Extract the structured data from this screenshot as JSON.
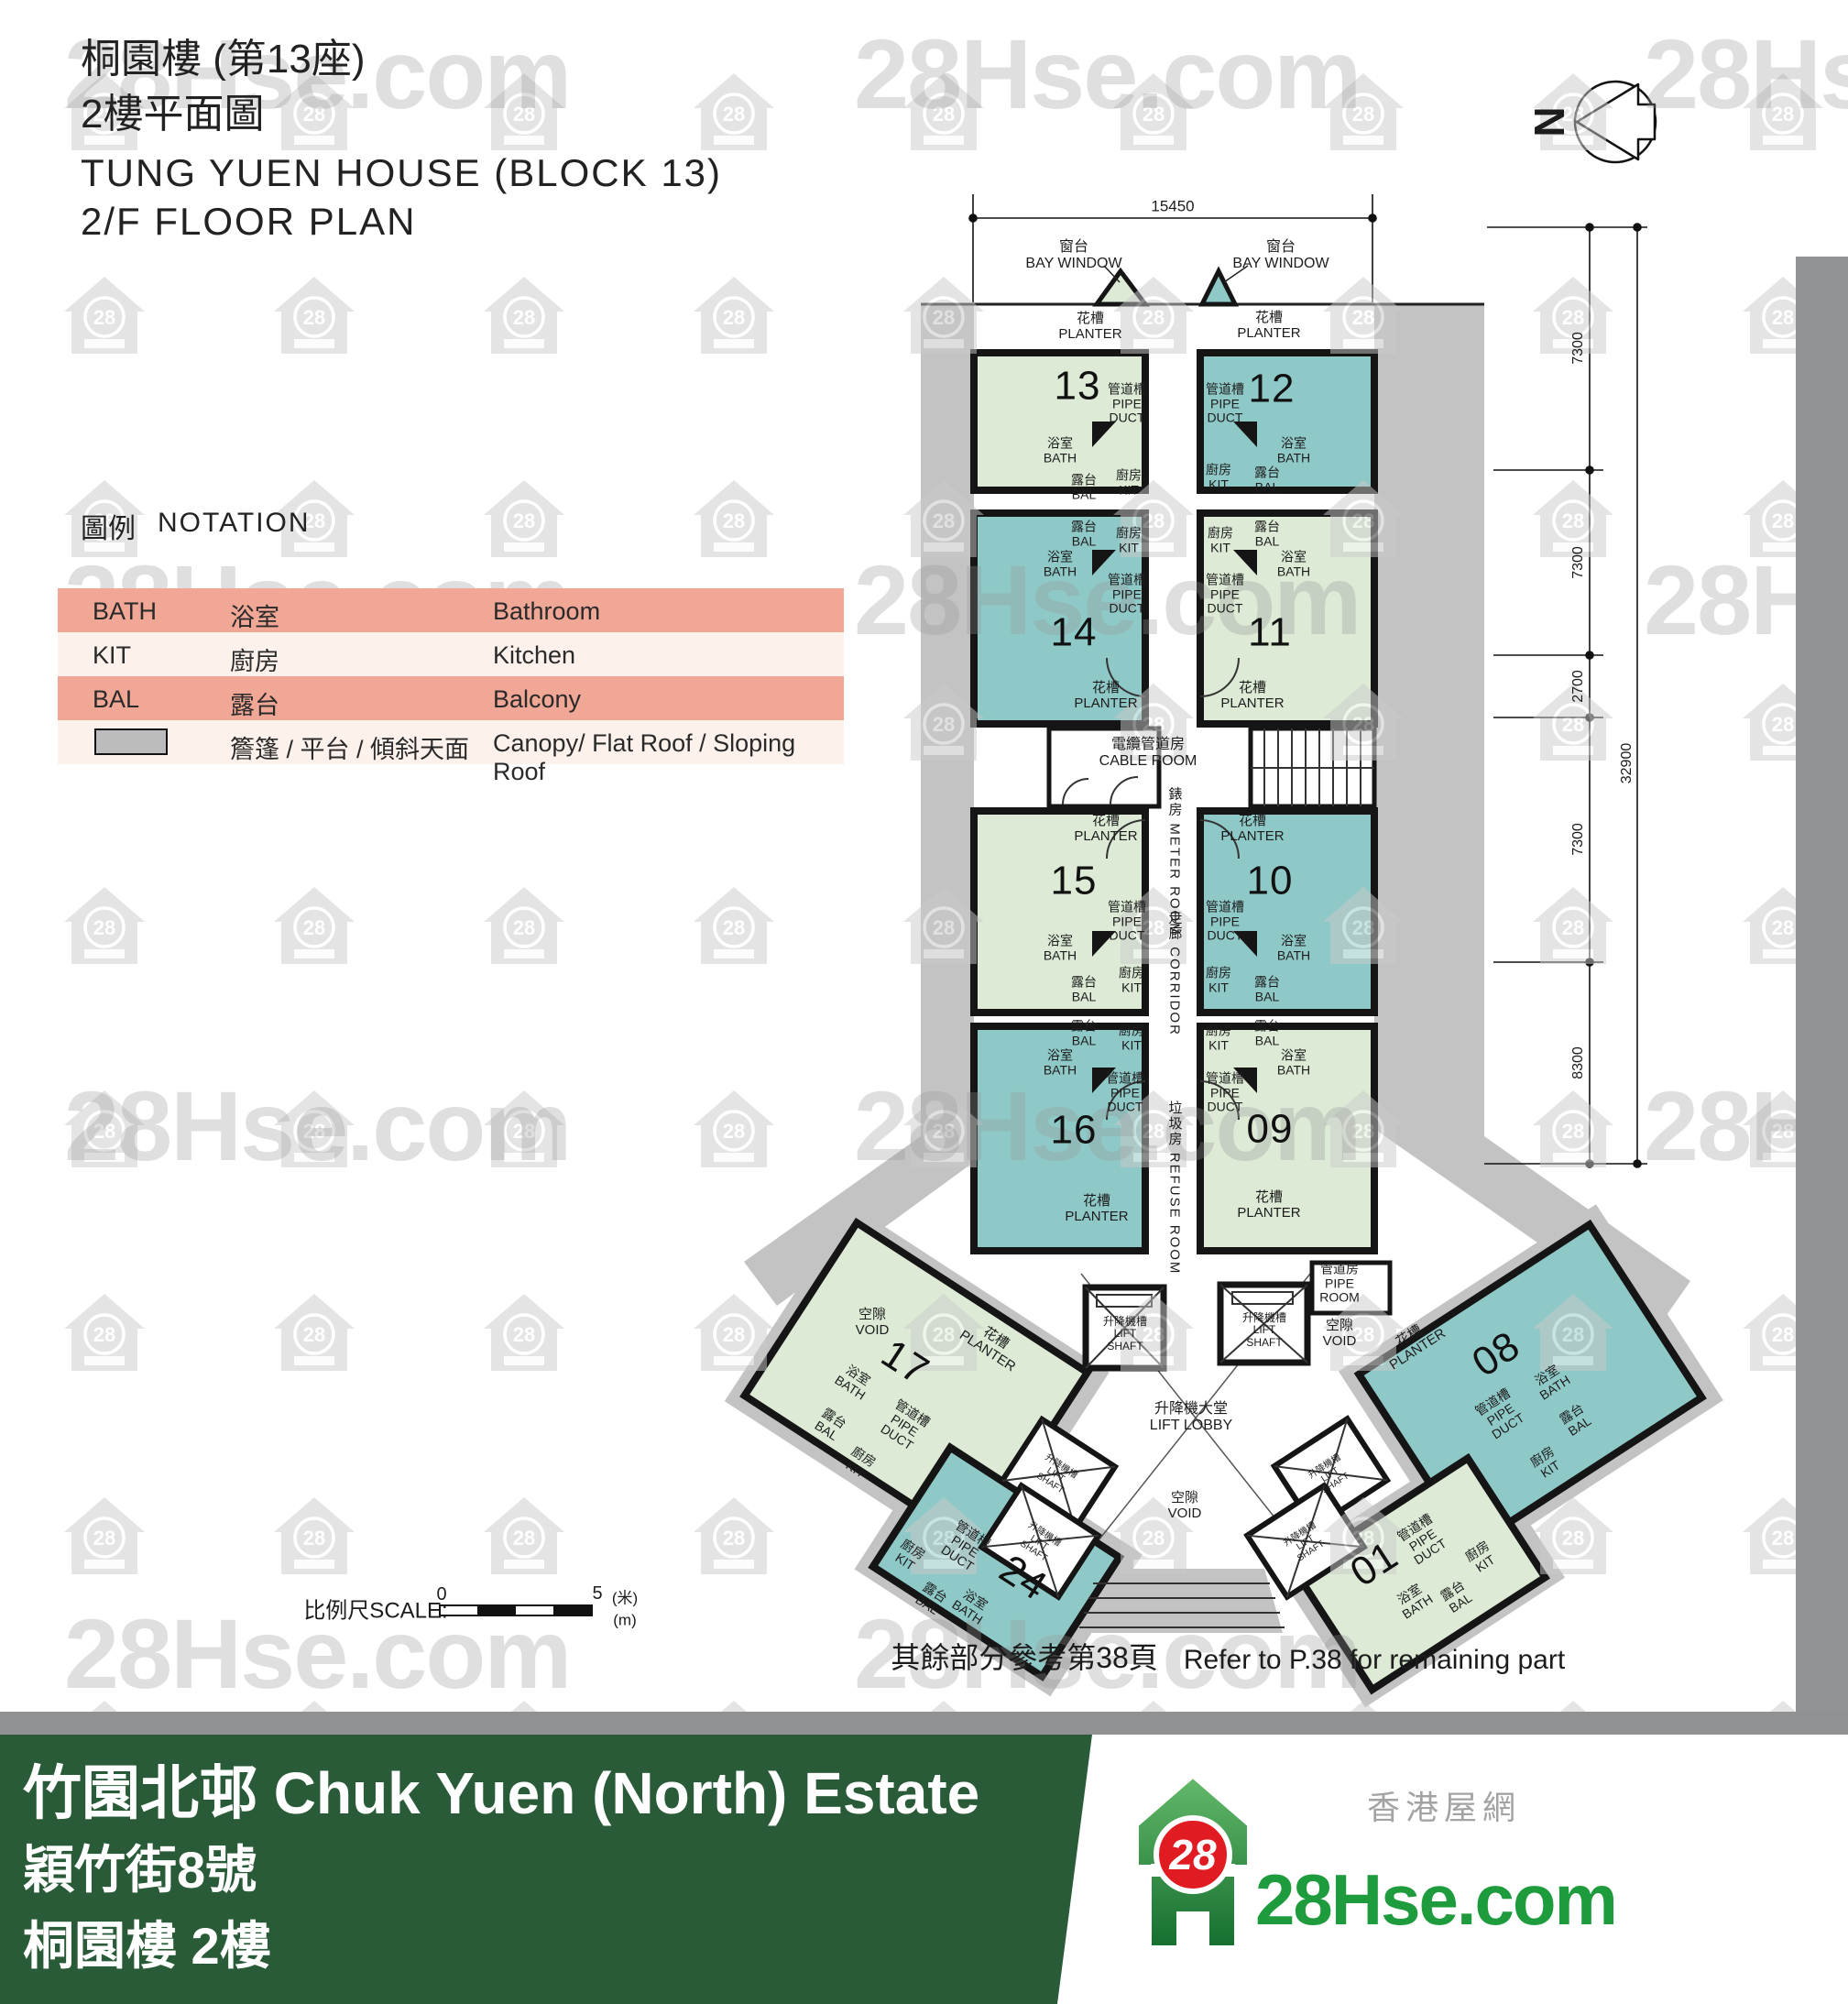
{
  "header": {
    "title_zh1": "桐園樓 (第13座)",
    "title_zh2": "2樓平面圖",
    "title_en1": "TUNG YUEN HOUSE (BLOCK 13)",
    "title_en2": "2/F FLOOR PLAN"
  },
  "north_label": "N",
  "notation": {
    "heading_zh": "圖例",
    "heading_en": "NOTATION"
  },
  "legend": {
    "rows": [
      {
        "abbr": "BATH",
        "zh": "浴室",
        "en": "Bathroom"
      },
      {
        "abbr": "KIT",
        "zh": "廚房",
        "en": "Kitchen"
      },
      {
        "abbr": "BAL",
        "zh": "露台",
        "en": "Balcony"
      },
      {
        "abbr": "",
        "zh": "簷篷 / 平台 / 傾斜天面",
        "en": "Canopy/ Flat Roof / Sloping Roof"
      }
    ]
  },
  "plan": {
    "units": {
      "u13": "13",
      "u12": "12",
      "u14": "14",
      "u11": "11",
      "u15": "15",
      "u10": "10",
      "u16": "16",
      "u09": "09",
      "u17": "17",
      "u24": "24",
      "u08": "08",
      "u01": "01"
    },
    "rooms": {
      "bay_window": "窗台\nBAY WINDOW",
      "planter": "花槽\nPLANTER",
      "pipe_duct": "管道槽\nPIPE\nDUCT",
      "bath": "浴室\nBATH",
      "kit": "廚房\nKIT",
      "bal": "露台\nBAL",
      "cable_room": "電纜管道房\nCABLE ROOM",
      "meter_room": "錶房 METER ROOM",
      "corridor": "走廊 CORRIDOR",
      "refuse_room": "垃圾房 REFUSE ROOM",
      "lift_shaft": "升降機槽\nLIFT\nSHAFT",
      "void": "空隙\nVOID",
      "pipe_room": "管道房\nPIPE\nROOM",
      "lift_lobby": "升降機大堂\nLIFT LOBBY"
    },
    "dims": {
      "top": "15450",
      "seg1": "7300",
      "seg2": "7300",
      "seg3": "2700",
      "seg4": "7300",
      "seg5": "8300",
      "overall": "32900"
    },
    "scale": {
      "label": "比例尺SCALE:",
      "start": "0",
      "end": "5",
      "unit_zh": "(米)",
      "unit_en": "(m)"
    },
    "note": {
      "zh": "其餘部分參考第38頁",
      "en": "Refer to P.38 for remaining part"
    }
  },
  "footer": {
    "estate": "竹園北邨 Chuk Yuen (North) Estate",
    "address": "穎竹街8號",
    "building": "桐園樓 2樓",
    "site_zh": "香港屋網",
    "logo_text": "28Hse.com",
    "logo_badge": "28"
  },
  "watermark": {
    "text": "28Hse.com",
    "badge": "28"
  }
}
